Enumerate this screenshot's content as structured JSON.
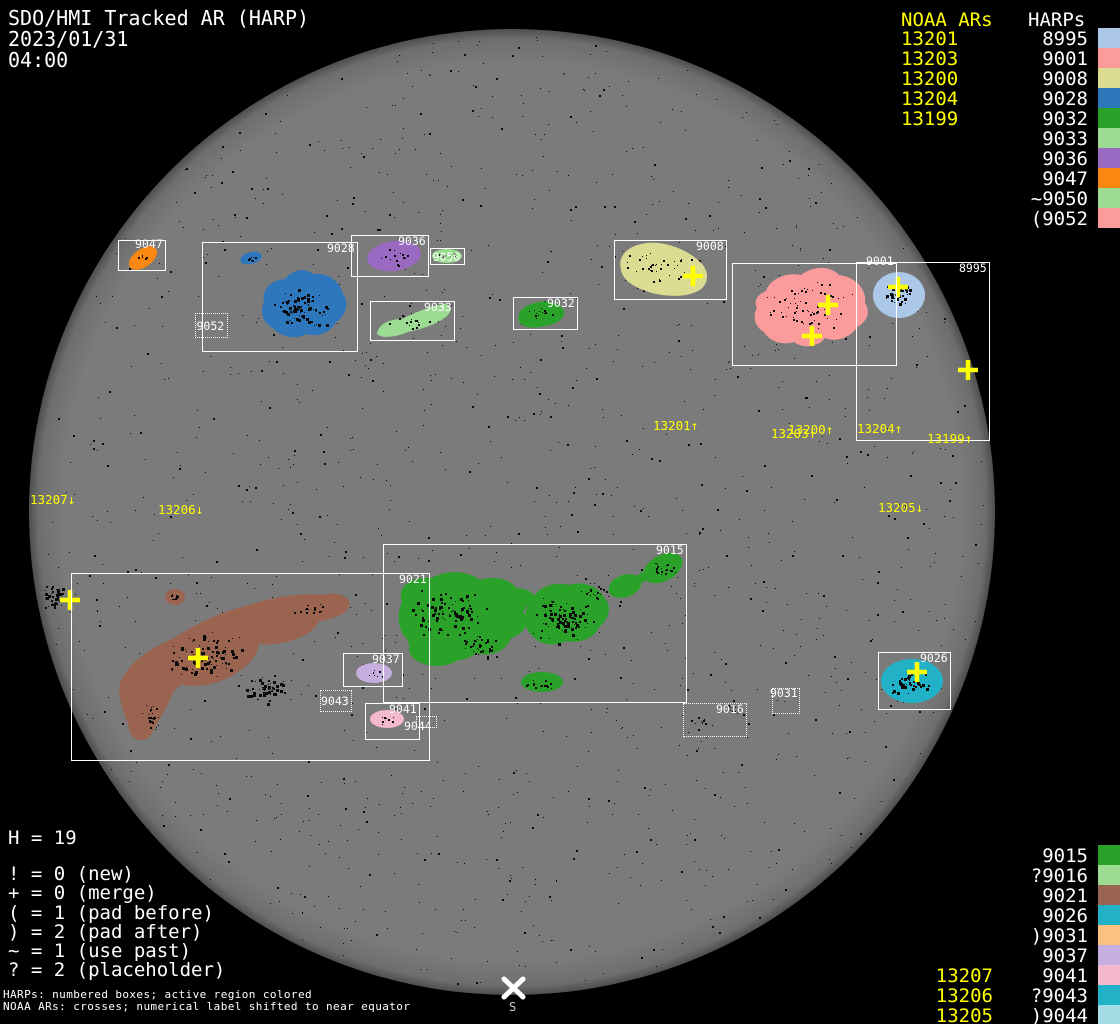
{
  "title": {
    "line1": "SDO/HMI Tracked AR (HARP)",
    "date": "2023/01/31",
    "time": "04:00"
  },
  "panels": {
    "top_right": {
      "noaa_header": "NOAA ARs",
      "harp_header": "HARPs",
      "rows": [
        {
          "noaa": "13201",
          "harp": "8995"
        },
        {
          "noaa": "13203",
          "harp": "9001"
        },
        {
          "noaa": "13200",
          "harp": "9008"
        },
        {
          "noaa": "13204",
          "harp": "9028"
        },
        {
          "noaa": "13199",
          "harp": "9032"
        },
        {
          "noaa": "",
          "harp": "9033"
        },
        {
          "noaa": "",
          "harp": "9036"
        },
        {
          "noaa": "",
          "harp": "9047"
        },
        {
          "noaa": "",
          "harp": "~9050"
        },
        {
          "noaa": "",
          "harp": "(9052"
        }
      ]
    },
    "bottom_right": {
      "rows": [
        {
          "noaa": "",
          "harp": "9015"
        },
        {
          "noaa": "",
          "harp": "?9016"
        },
        {
          "noaa": "",
          "harp": "9021"
        },
        {
          "noaa": "",
          "harp": "9026"
        },
        {
          "noaa": "",
          "harp": ")9031"
        },
        {
          "noaa": "",
          "harp": "9037"
        },
        {
          "noaa": "13207",
          "harp": "9041"
        },
        {
          "noaa": "13206",
          "harp": "?9043"
        },
        {
          "noaa": "13205",
          "harp": ")9044"
        }
      ]
    }
  },
  "legend": {
    "h_count": "H = 19",
    "lines": [
      "! = 0 (new)",
      "+ = 0 (merge)",
      "( = 1 (pad before)",
      ") = 2 (pad after)",
      "~ = 1 (use past)",
      "? = 2 (placeholder)"
    ]
  },
  "footer": {
    "line1": "HARPs: numbered boxes; active region colored",
    "line2": "NOAA ARs: crosses; numerical label shifted to near equator"
  },
  "south_marker": {
    "label": "S"
  },
  "colors": {
    "background": "#000000",
    "disk_gray": "#7b7b7b",
    "limb_gray": "#4e4e4e",
    "noaa_yellow": "#ffff00",
    "box_white": "#ffffff",
    "speckle_black": "#0a0a0a"
  },
  "harp_colors": {
    "8995": "#abc8e8",
    "9001": "#fb9b9b",
    "9008": "#dbdb92",
    "9015": "#2aa22a",
    "9016": "#9bdc92",
    "9021": "#9a6450",
    "9026": "#22b2c8",
    "9028": "#2f77bd",
    "9031": "#fcc083",
    "9032": "#2aa22a",
    "9033": "#9bdc92",
    "9036": "#9a6ac2",
    "9037": "#c6aede",
    "9041": "#f4b9cf",
    "9043": "#22b2c8",
    "9044": "#a5dce5",
    "9047": "#fb8713",
    "9050": "#9bdc92",
    "9052": "#fb9b9b"
  },
  "disk": {
    "cx": 512,
    "cy": 512,
    "r": 483
  },
  "harp_boxes": [
    {
      "id": "9047",
      "label": "9047",
      "x": 118,
      "y": 240,
      "w": 48,
      "h": 31,
      "style": "solid",
      "lpos": "tr",
      "ldy": -2
    },
    {
      "id": "9028",
      "label": "9028",
      "x": 202,
      "y": 242,
      "w": 156,
      "h": 110,
      "style": "solid",
      "lpos": "tr"
    },
    {
      "id": "9052",
      "label": "9052",
      "x": 195,
      "y": 313,
      "w": 33,
      "h": 25,
      "style": "dotted",
      "lpos": "center"
    },
    {
      "id": "9036",
      "label": "9036",
      "x": 351,
      "y": 235,
      "w": 78,
      "h": 42,
      "style": "solid",
      "lpos": "tr"
    },
    {
      "id": "9050",
      "label": "9050",
      "x": 430,
      "y": 248,
      "w": 35,
      "h": 17,
      "style": "solid",
      "lpos": "center"
    },
    {
      "id": "9033",
      "label": "9033",
      "x": 370,
      "y": 301,
      "w": 85,
      "h": 40,
      "style": "solid",
      "lpos": "tr"
    },
    {
      "id": "9032",
      "label": "9032",
      "x": 513,
      "y": 297,
      "w": 65,
      "h": 33,
      "style": "solid",
      "lpos": "tr"
    },
    {
      "id": "9008",
      "label": "9008",
      "x": 614,
      "y": 240,
      "w": 113,
      "h": 60,
      "style": "solid",
      "lpos": "tr"
    },
    {
      "id": "9001",
      "label": "9001",
      "x": 732,
      "y": 263,
      "w": 165,
      "h": 103,
      "style": "solid",
      "lpos": "tr",
      "ldy": -8
    },
    {
      "id": "8995",
      "label": "8995",
      "x": 856,
      "y": 262,
      "w": 134,
      "h": 179,
      "style": "solid",
      "lpos": "tr"
    },
    {
      "id": "9015",
      "label": "9015",
      "x": 383,
      "y": 544,
      "w": 304,
      "h": 159,
      "style": "solid",
      "lpos": "tr"
    },
    {
      "id": "9021",
      "label": "9021",
      "x": 71,
      "y": 573,
      "w": 359,
      "h": 188,
      "style": "solid",
      "lpos": "tr"
    },
    {
      "id": "9037",
      "label": "9037",
      "x": 343,
      "y": 653,
      "w": 60,
      "h": 34,
      "style": "solid",
      "lpos": "tr"
    },
    {
      "id": "9043",
      "label": "9043",
      "x": 320,
      "y": 690,
      "w": 32,
      "h": 22,
      "style": "dotted",
      "lpos": "center"
    },
    {
      "id": "9041",
      "label": "9041",
      "x": 365,
      "y": 703,
      "w": 55,
      "h": 37,
      "style": "solid",
      "lpos": "tr"
    },
    {
      "id": "9044",
      "label": "9044",
      "x": 416,
      "y": 716,
      "w": 21,
      "h": 12,
      "style": "dotted",
      "lpos": "abs",
      "lx": 404,
      "ly": 721
    },
    {
      "id": "9016",
      "label": "9016",
      "x": 683,
      "y": 703,
      "w": 64,
      "h": 34,
      "style": "dotted",
      "lpos": "tr"
    },
    {
      "id": "9031",
      "label": "9031",
      "x": 772,
      "y": 688,
      "w": 28,
      "h": 26,
      "style": "dotted",
      "lpos": "tl",
      "ldy": -1
    },
    {
      "id": "9026",
      "label": "9026",
      "x": 878,
      "y": 652,
      "w": 73,
      "h": 58,
      "style": "solid",
      "lpos": "tr"
    }
  ],
  "noaa_ars": [
    {
      "id": "13201",
      "label": "13201↑",
      "label_x": 653,
      "label_y": 419,
      "cross_x": 693,
      "cross_y": 276
    },
    {
      "id": "13200",
      "label": "13200↑",
      "label_x": 788,
      "label_y": 423,
      "cross_x": 828,
      "cross_y": 305
    },
    {
      "id": "13203",
      "label": "13203↑",
      "label_x": 771,
      "label_y": 427,
      "cross_x": 812,
      "cross_y": 336
    },
    {
      "id": "13204",
      "label": "13204↑",
      "label_x": 857,
      "label_y": 422,
      "cross_x": 898,
      "cross_y": 287
    },
    {
      "id": "13199",
      "label": "13199↑",
      "label_x": 927,
      "label_y": 432,
      "cross_x": 968,
      "cross_y": 370
    },
    {
      "id": "13207",
      "label": "13207↓",
      "label_x": 30,
      "label_y": 493,
      "cross_x": 70,
      "cross_y": 600
    },
    {
      "id": "13206",
      "label": "13206↓",
      "label_x": 158,
      "label_y": 503,
      "cross_x": 198,
      "cross_y": 658
    },
    {
      "id": "13205",
      "label": "13205↓",
      "label_x": 878,
      "label_y": 501,
      "cross_x": 917,
      "cross_y": 672
    }
  ],
  "chart_data": {
    "type": "table",
    "title": "SDO/HMI Tracked AR (HARP)",
    "datetime": "2023/01/31 04:00",
    "harp_total": 19,
    "flag_counts": {
      "new": 0,
      "merge": 0,
      "pad_before": 1,
      "pad_after": 2,
      "use_past": 1,
      "placeholder": 2
    },
    "noaa_to_harp_pairs": [
      [
        "13201",
        "8995 row"
      ],
      [
        "13203",
        "9001 row"
      ],
      [
        "13200",
        "9008 row"
      ],
      [
        "13204",
        "9028 row"
      ],
      [
        "13199",
        "9032 row"
      ],
      [
        "13207",
        "9041 row"
      ],
      [
        "13206",
        "9043 row"
      ],
      [
        "13205",
        "9044 row"
      ]
    ],
    "harps_listed_upper": [
      "8995",
      "9001",
      "9008",
      "9028",
      "9032",
      "9033",
      "9036",
      "9047",
      "~9050",
      "(9052"
    ],
    "harps_listed_lower": [
      "9015",
      "?9016",
      "9021",
      "9026",
      ")9031",
      "9037",
      "9041",
      "?9043",
      ")9044"
    ],
    "noaa_listed_upper": [
      "13201",
      "13203",
      "13200",
      "13204",
      "13199"
    ],
    "noaa_listed_lower": [
      "13207",
      "13206",
      "13205"
    ]
  }
}
